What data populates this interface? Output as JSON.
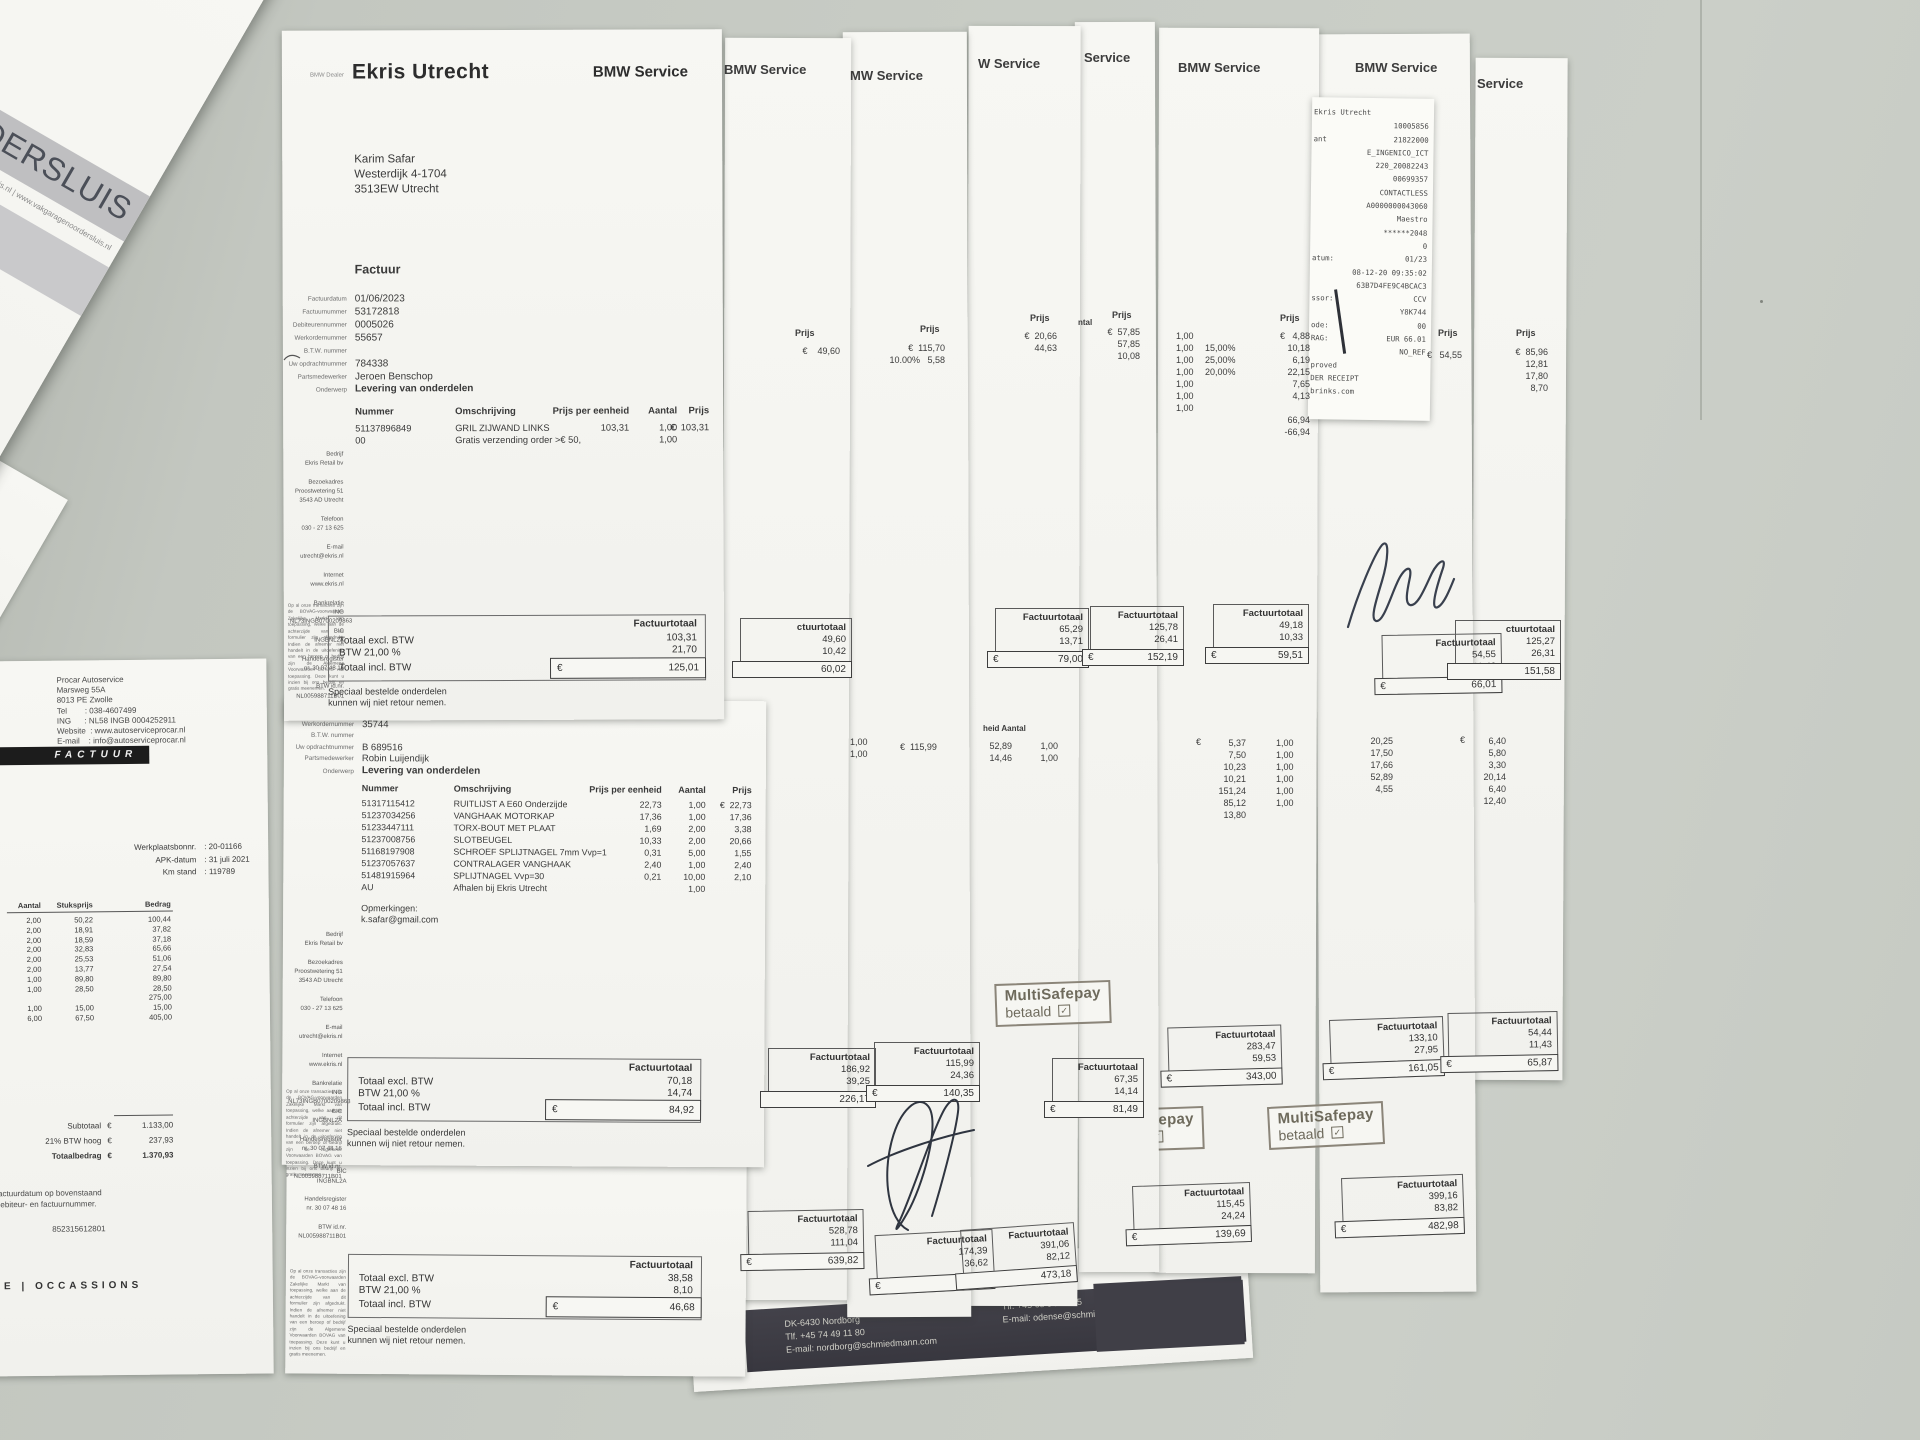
{
  "noordersluis": {
    "title_fragment": "RDERSLUIS",
    "contact_line": "@vakgaragenoordersluis.nl   |   www.vakgaragenoordersluis.nl",
    "fields": "Klant  : 561357\n     Pagina 1 van 1\nKm-stand  : 112050\nMonteur  : Bart Goeij",
    "bedrag_label": "Bedrag (€)",
    "note_fragment": ", niet op korte termijn nieuw",
    "amounts": "16,49\n28,92\n195,00\n\n185,00\n49,50"
  },
  "procar": {
    "header": "Procar Autoservice\nMarsweg 55A\n8013 PE Zwolle\nTel        : 038-4607499\nING      : NL58 INGB 0004252911\nWebsite  : www.autoserviceprocar.nl\nE-mail    : info@autoserviceprocar.nl",
    "banner": "FACTUUR",
    "left_fragment": "9",
    "field_labels": "Werkplaatsbonnr.\nAPK-datum\nKm stand",
    "field_values": ": 20-01166\n: 31 juli 2021\n: 119789",
    "col_aantal": "Aantal",
    "col_stuksprijs": "Stuksprijs",
    "col_bedrag": "Bedrag",
    "aantal": "2,00\n2,00\n2,00\n2,00\n2,00\n2,00\n1,00\n1,00\n\n1,00\n6,00",
    "stuksprijs": "50,22\n18,91\n18,59\n32,83\n25,53\n13,77\n89,80\n28,50\n\n15,00\n67,50",
    "bedrag": "100,44\n37,82\n37,18\n65,66\n51,06\n27,54\n89,80\n28,50\n275,00\n15,00\n405,00",
    "subtotaal_label": "Subtotaal",
    "subtotaal_eur": "€",
    "subtotaal": "1.133,00",
    "btw_label": "21% BTW hoog",
    "btw_eur": "€",
    "btw": "237,93",
    "totaal_label": "Totaalbedrag",
    "totaal_eur": "€",
    "totaal": "1.370,93",
    "note": "factuurdatum op bovenstaand\ndebiteur- en factuurnummer.",
    "btw_nr": "852315612801",
    "footer": "CE   |   OCCASSIONS"
  },
  "ekris1": {
    "dealer_tag": "BMW Dealer",
    "title": "Ekris Utrecht",
    "service": "BMW Service",
    "address": "Karim Safar\nWesterdijk 4-1704\n3513EW  Utrecht",
    "factuur": "Factuur",
    "field_labels": "Factuurdatum\nFactuurnummer\nDebiteurennummer\nWerkordernummer\nB.T.W. nummer\nUw opdrachtnummer\nPartsmedewerker",
    "field_values": "01/06/2023\n53172818\n0005026\n55657\n\n784338\nJeroen Benschop",
    "onderwerp_label": "Onderwerp",
    "onderwerp": "Levering van onderdelen",
    "h_nummer": "Nummer",
    "h_omschrijving": "Omschrijving",
    "h_eenheid": "Prijs per eenheid",
    "h_aantal": "Aantal",
    "h_prijs": "Prijs",
    "it_nummer": "51137896849\n00",
    "it_omschrijving": "GRIL ZIJWAND LINKS\nGratis verzending order >€ 50,",
    "it_eenheid": "103,31",
    "it_aantal": "1,00\n1,00",
    "it_prijs": "€  103,31",
    "tot_head": "Factuurtotaal",
    "tot_excl_label": "Totaal excl. BTW",
    "tot_excl": "103,31",
    "tot_btw_label": "BTW 21,00 %",
    "tot_btw": "21,70",
    "tot_incl_label": "Totaal incl. BTW",
    "tot_eur": "€",
    "tot_incl": "125,01",
    "disclaimer": "Speciaal bestelde onderdelen\nkunnen wij niet retour nemen."
  },
  "ekris2": {
    "field_labels": "Debiteurennummer\nWerkordernummer\nB.T.W. nummer\nUw opdrachtnummer\nPartsmedewerker",
    "field_values": "0005026\n35744\n\nB 689516\nRobin Luijendijk",
    "onderwerp_label": "Onderwerp",
    "onderwerp": "Levering van onderdelen",
    "it_nummer": "51317115412\n51237034256\n51233447111\n51237008756\n51168197908\n51237057637\n51481915964\nAU",
    "it_omschrijving": "RUITLIJST A E60 Onderzijde\nVANGHAAK MOTORKAP\nTORX-BOUT MET PLAAT\nSLOTBEUGEL\nSCHROEF SPLIJTNAGEL 7mm  Vvp=1\nCONTRALAGER VANGHAAK\nSPLIJTNAGEL  Vvp=30\nAfhalen bij Ekris Utrecht",
    "it_eenheid": "22,73\n17,36\n1,69\n10,33\n0,31\n2,40\n0,21",
    "it_aantal": "1,00\n1,00\n2,00\n2,00\n5,00\n1,00\n10,00\n1,00",
    "it_prijs": "€  22,73\n17,36\n3,38\n20,66\n1,55\n2,40\n2,10",
    "opmerkingen": "Opmerkingen:\nk.safar@gmail.com",
    "tot_excl": "70,18",
    "tot_btw": "14,74",
    "tot_incl": "84,92"
  },
  "ekris3": {
    "sidebar_fragment": "NL73INGB0700209863\nBIC\nINGBNL2A\n\nHandelsregister\nnr. 30 07 48 16\n\nBTW id.nr.\nNL005988711B01",
    "tot_excl": "38,58",
    "tot_btw": "8,10",
    "tot_incl": "46,68"
  },
  "ekris_shared": {
    "sidebar": "Bedrijf\nEkris Retail bv\n\nBezoekadres\nProostwetering 51\n3543 AD Utrecht\n\nTelefoon\n030 - 27 13 625\n\nE-mail\nutrecht@ekris.nl\n\nInternet\nwww.ekris.nl\n\nBankrelatie\nING\nNL73INGB0700209863\nBIC\nINGBNL2A\n\nHandelsregister\nnr. 30 07 48 16\n\nBTW id.nr.\nNL005988711B01",
    "legal": "Op al onze transacties zijn de BOVAG-voorwaarden Zakelijke Markt van toepassing, welke aan de achterzijde van dit formulier zijn afgedrukt. Indien de afnemer niet handelt in de uitoefening van een beroep of bedrijf zijn de Algemene Voorwaarden BOVAG van toepassing. Deze kunt u inzien bij ons bedrijf en gratis meenemen."
  },
  "receipt": {
    "labels": "Ekris Utrecht\n\nant\n\n\n\n\n\n\n\n\natum:\n\n\nssor:\n\node:\nRAG:\n\nproved\nDER RECEIPT\nbrinks.com",
    "values": "\n10005856\n21822000\nE_INGENICO_ICT\n220_20082243\n00699357\nCONTACTLESS\nA0000000043060\nMaestro\n******2048\n0\n01/23\n08-12-20 09:35:02\n63B7D4FE9C4BCAC3\nCCV\nY8K744\n00\nEUR 66.01\nNO_REF\n\n\n"
  },
  "columns": {
    "b": {
      "header": "BMW Service",
      "prijs_label": "Prijs",
      "prijs_val": "€    49,60",
      "box1": {
        "label": "ctuurtotaal",
        "nums": "49,60\n10,42",
        "cur": "",
        "total": "60,02"
      },
      "box2": {
        "label": "Factuurtotaal",
        "nums": "186,92\n39,25",
        "cur": "",
        "total": "226,17"
      },
      "box3": {
        "label": "Factuurtotaal",
        "nums": "528,78\n111,04",
        "cur": "€",
        "total": "639,82"
      }
    },
    "c": {
      "header": "MW Service",
      "ntal": "ntal",
      "prijs_label": "Prijs",
      "prijs_vals": "€  115,70\n10.00%   5,58",
      "mid_qty": "1,00\n1,00",
      "mid_val": "€  115,99",
      "box_mid": {
        "label": "Factuurtotaal",
        "nums": "115,99\n24,36",
        "cur": "€",
        "total": "140,35"
      },
      "box_bot": {
        "label": "Factuurtotaal",
        "nums": "174,39\n36,62",
        "cur": "€",
        "total": "211,01"
      }
    },
    "d": {
      "header": "W Service",
      "prijs_label": "Prijs",
      "prijs_vals": "€  20,66\n44,63",
      "mid_label": "heid   Aantal",
      "mid_v1": "52,89\n14,46",
      "mid_v2": "1,00\n1,00",
      "box1": {
        "label": "Factuurtotaal",
        "nums": "65,29\n13,71",
        "cur": "€",
        "total": "79,00"
      },
      "box2": {
        "label": "Factuurtotaal",
        "nums": "67,35\n14,14",
        "cur": "€",
        "total": "81,49"
      },
      "box3": {
        "label": "Factuurtotaal",
        "nums": "391,06\n82,12",
        "cur": "",
        "total": "473,18"
      }
    },
    "e": {
      "header": "Service",
      "ntal": "ntal",
      "qty": "1,00\n1,00\n1,00",
      "prijs_label": "Prijs",
      "prijs_vals": "€  57,85\n57,85\n10,08",
      "box1": {
        "label": "Factuurtotaal",
        "nums": "125,78\n26,41",
        "cur": "€",
        "total": "152,19"
      }
    },
    "f": {
      "header": "BMW Service",
      "prijs_label": "Prijs",
      "qty": "1,00\n1,00\n1,00\n1,00\n1,00\n1,00\n1,00",
      "disc": "15,00%\n25,00%\n20,00%",
      "price": "€   4,88\n10,18\n6,19\n22,15\n7,65\n4,13\n\n66,94\n-66,94",
      "mid_eur": "€",
      "mid_v1": "5,37\n7,50\n10,23\n10,21\n151,24\n85,12\n13,80",
      "box1": {
        "label": "Factuurtotaal",
        "nums": "49,18\n10,33",
        "cur": "€",
        "total": "59,51"
      },
      "box2": {
        "label": "Factuurtotaal",
        "nums": "283,47\n59,53",
        "cur": "€",
        "total": "343,00"
      },
      "box3": {
        "label": "Factuurtotaal",
        "nums": "115,45\n24,24",
        "cur": "€",
        "total": "139,69"
      }
    },
    "g": {
      "header": "BMW Service",
      "prijs_label": "Prijs",
      "prijs_val": "€   54,55",
      "qty": "1,00\n1,00\n1,00\n1,00\n1,00\n1,00",
      "mid_v": "20,25\n17,50\n17,66\n52,89\n4,55",
      "box1": {
        "label": "Factuurtotaal",
        "nums": "54,55\n11,46",
        "cur": "€",
        "total": "66,01"
      },
      "box2": {
        "label": "Factuurtotaal",
        "nums": "133,10\n27,95",
        "cur": "€",
        "total": "161,05"
      },
      "box3": {
        "label": "Factuurtotaal",
        "nums": "399,16\n83,82",
        "cur": "€",
        "total": "482,98"
      }
    },
    "h": {
      "header": "Service",
      "prijs_label": "Prijs",
      "prijs_vals": "€  85,96\n12,81\n17,80\n8,70",
      "mid_eur": "€",
      "mid_v": "6,40\n5,80\n3,30\n20,14\n6,40\n12,40",
      "box1": {
        "label": "ctuurtotaal",
        "nums": "125,27\n26,31",
        "cur": "",
        "total": "151,58"
      },
      "box2": {
        "label": "Factuurtotaal",
        "nums": "54,44\n11,43",
        "cur": "€",
        "total": "65,87"
      }
    }
  },
  "stamp": {
    "line1": "MultiSafepay",
    "line2": "betaald",
    "check": "✓"
  },
  "footer_bar": {
    "col1": "DK-6430 Nordborg\nTlf. +45 74 49 11 80\nE-mail: nordborg@schmiedmann.com",
    "col2": "Tlf: +45 65 94 15 45\nE-mail: odense@schmiedmann.com"
  }
}
